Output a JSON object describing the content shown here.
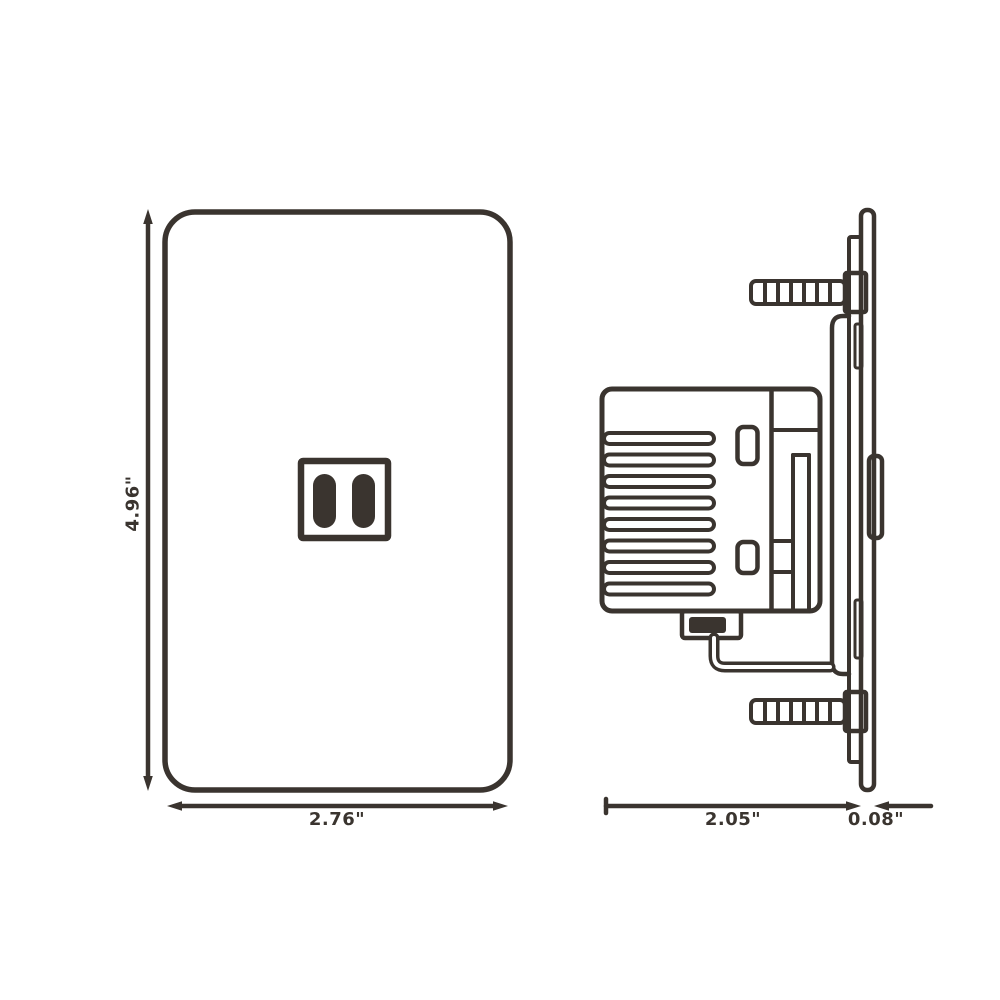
{
  "colors": {
    "line": "#3a342f",
    "background": "#ffffff"
  },
  "front_view": {
    "height_label": "4.96\"",
    "width_label": "2.76\""
  },
  "side_view": {
    "depth_label": "2.05\"",
    "plate_thickness_label": "0.08\""
  }
}
